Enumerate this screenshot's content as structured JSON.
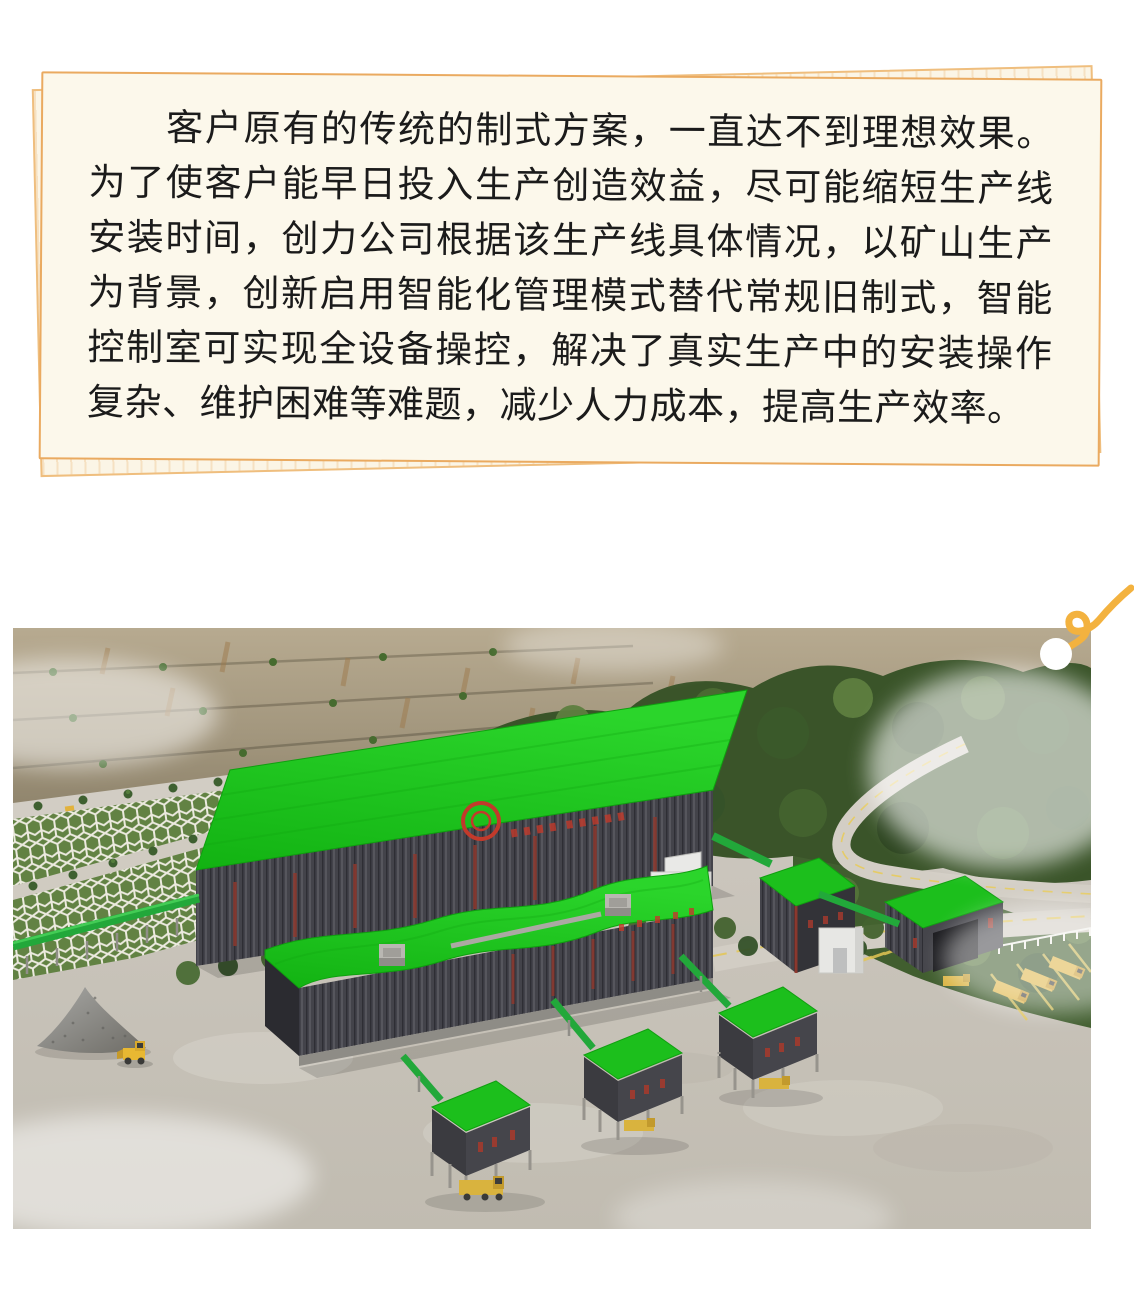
{
  "article": {
    "paragraph": "　　客户原有的传统的制式方案，一直达不到理想效果。为了使客户能早日投入生产创造效益，尽可能缩短生产线安装时间，创力公司根据该生产线具体情况，以矿山生产为背景，创新启用智能化管理模式替代常规旧制式，智能控制室可实现全设备操控，解决了真实生产中的安装操作复杂、维护困难等难题，减少人力成本，提高生产效率。"
  },
  "illustration": {
    "alt": "aerial-render-of-mine-crushing-plant",
    "elements": [
      "quarry-cliff",
      "forest",
      "honeycomb-slope",
      "terrace-roads",
      "main-workshop",
      "wavy-roof-workshop",
      "conveyor-silos",
      "stockpile",
      "wheel-loader",
      "haul-trucks",
      "conveyors",
      "mist"
    ]
  },
  "palette": {
    "card_background": "#FCF8EB",
    "card_border": "#EAAA60",
    "back_sheet_border": "#EFBE7E",
    "photo_frame": "#F6C56A",
    "pin_squiggle": "#F3B23F",
    "roof_green": "#1CC11C",
    "wall_dark": "#43434A",
    "accent_red": "#C23A2B",
    "concrete": "#C9C4BB",
    "rock_tan": "#A79A83",
    "forest_green": "#3E5B2D"
  }
}
